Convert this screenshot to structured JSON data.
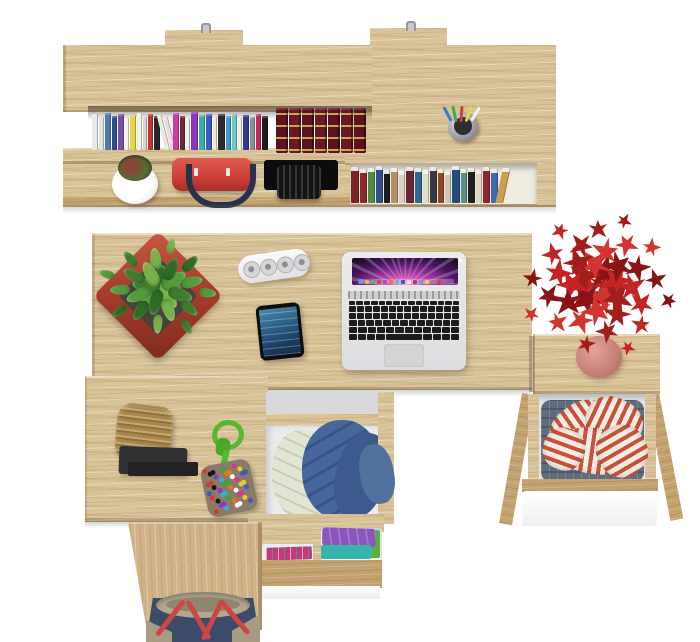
{
  "meta": {
    "description": "Top-down 3D product render of a light-oak desk set: wall shelf with books, main desk with laptop, phone, power strip and plants, open drawers with clothes, pedestal and duffel bag",
    "canvas": {
      "width": 700,
      "height": 642
    },
    "background": "#ffffff"
  },
  "palette": {
    "wood": "#d9c399",
    "wood_vertical": "#cfb287",
    "wood_edge": "#c3a26f",
    "white_front": "#ffffff",
    "shadow": "rgba(90,85,75,0.30)"
  },
  "shelf": {
    "hanger_count": 2,
    "hook_color": "#9a9a9c",
    "row1_spines": [
      {
        "w": 6,
        "c": "#e9e9e9",
        "h": 36
      },
      {
        "w": 5,
        "c": "#dfe3e6",
        "h": 33
      },
      {
        "w": 6,
        "c": "#4e7ab0",
        "h": 37
      },
      {
        "w": 5,
        "c": "#2e4e8e",
        "h": 34
      },
      {
        "w": 6,
        "c": "#7a4fa8",
        "h": 36
      },
      {
        "w": 4,
        "c": "#f2f0ec",
        "h": 32
      },
      {
        "w": 6,
        "c": "#e8d24a",
        "h": 35
      },
      {
        "w": 5,
        "c": "#f5f2e4",
        "h": 37
      },
      {
        "w": 4,
        "c": "#d8d5cf",
        "h": 33
      },
      {
        "w": 5,
        "c": "#c23434",
        "h": 36
      },
      {
        "w": 6,
        "c": "#262628",
        "h": 34
      },
      {
        "w": 5,
        "c": "#ece8e0",
        "h": 35,
        "lean": 14
      },
      {
        "w": 5,
        "c": "#f0d8e0",
        "h": 33,
        "lean": 14
      },
      {
        "w": 6,
        "c": "#d238a2",
        "h": 37
      },
      {
        "w": 5,
        "c": "#6a2a35",
        "h": 34
      },
      {
        "w": 4,
        "c": "#f2eee6",
        "h": 32
      },
      {
        "w": 7,
        "c": "#9232c2",
        "h": 38
      },
      {
        "w": 6,
        "c": "#34b2aa",
        "h": 35
      },
      {
        "w": 6,
        "c": "#3a5ac8",
        "h": 36
      },
      {
        "w": 4,
        "c": "#f0ead8",
        "h": 33
      },
      {
        "w": 7,
        "c": "#2a2a2c",
        "h": 36
      },
      {
        "w": 5,
        "c": "#3a98d2",
        "h": 34
      },
      {
        "w": 5,
        "c": "#6ac8c2",
        "h": 36
      },
      {
        "w": 4,
        "c": "#f2ece2",
        "h": 32
      },
      {
        "w": 6,
        "c": "#30389a",
        "h": 35
      },
      {
        "w": 5,
        "c": "#8a8f96",
        "h": 33
      },
      {
        "w": 5,
        "c": "#c82858",
        "h": 36
      },
      {
        "w": 6,
        "c": "#1e1e20",
        "h": 34
      }
    ],
    "classics": {
      "count": 7,
      "colors": [
        "#5c1220",
        "#6b1826"
      ],
      "gold": "#caa84a",
      "width": 12,
      "height": 45
    },
    "row2_spines": [
      {
        "w": 8,
        "c": "#7a2424",
        "h": 36
      },
      {
        "w": 7,
        "c": "#8a2a2a",
        "h": 34
      },
      {
        "w": 7,
        "c": "#4f8a4a",
        "h": 35
      },
      {
        "w": 7,
        "c": "#2f4f86",
        "h": 37
      },
      {
        "w": 6,
        "c": "#1c1c1e",
        "h": 33
      },
      {
        "w": 7,
        "c": "#b2906a",
        "h": 35
      },
      {
        "w": 6,
        "c": "#d8d2c2",
        "h": 32
      },
      {
        "w": 8,
        "c": "#6b2330",
        "h": 36
      },
      {
        "w": 7,
        "c": "#2a6a8e",
        "h": 35
      },
      {
        "w": 6,
        "c": "#e2dcc8",
        "h": 33
      },
      {
        "w": 7,
        "c": "#3a3a3c",
        "h": 36
      },
      {
        "w": 6,
        "c": "#8a4a2a",
        "h": 34
      },
      {
        "w": 6,
        "c": "#d0c8b4",
        "h": 32
      },
      {
        "w": 8,
        "c": "#254a7e",
        "h": 37
      },
      {
        "w": 6,
        "c": "#5a8e88",
        "h": 34
      },
      {
        "w": 7,
        "c": "#1e2022",
        "h": 35
      },
      {
        "w": 6,
        "c": "#ddd6c4",
        "h": 33
      },
      {
        "w": 7,
        "c": "#8e2430",
        "h": 36
      },
      {
        "w": 7,
        "c": "#3a6ab0",
        "h": 34
      },
      {
        "w": 8,
        "c": "#c8a050",
        "h": 35,
        "lean": -12
      }
    ],
    "pen_cup": {
      "cup_color": "#8e8e90",
      "pens": [
        {
          "c": "#3a7ad0",
          "rot": -28
        },
        {
          "c": "#48a838",
          "rot": -12
        },
        {
          "c": "#d04040",
          "rot": 4
        },
        {
          "c": "#e8d44a",
          "rot": 18
        },
        {
          "c": "#f2f2f2",
          "rot": 32
        }
      ]
    },
    "items": {
      "cup_plant": {
        "pot": "#ffffff",
        "plant": "#5a6a34"
      },
      "red_bag": {
        "body": "#cc3f38",
        "handles": "#27324a"
      },
      "camera_bag": {
        "body": "#141416"
      }
    }
  },
  "laptop": {
    "body_color": "#e6e6e8",
    "key_color": "#1c1c1e",
    "screen_colors": [
      "#f0a0e0",
      "#d455b8",
      "#8a2f97",
      "#4a1560",
      "#1e0c28"
    ],
    "keyboard_rows": [
      {
        "keys": 15,
        "h": 4
      },
      {
        "keys": 14,
        "h": 6
      },
      {
        "keys": 14,
        "h": 6
      },
      {
        "keys": 13,
        "h": 6
      },
      {
        "keys": 12,
        "h": 6
      },
      {
        "keys": 9,
        "h": 6,
        "space": true
      }
    ],
    "dock_colors": [
      "#4aa8e8",
      "#e8b84a",
      "#58b848",
      "#d04848",
      "#9a58c8",
      "#e87838",
      "#48c8c0",
      "#3858c8",
      "#e8e8e8",
      "#b03878",
      "#58a8d8",
      "#e8d44a",
      "#888890",
      "#c04838"
    ]
  },
  "phone": {
    "body": "#0e0e10",
    "screen_top": "#4a89a8",
    "screen_bottom": "#122c48"
  },
  "power_strip": {
    "body": "#f2f2f4",
    "socket_count": 4,
    "socket_color": "#8e8e92"
  },
  "green_plant": {
    "name": "succulent-leaf",
    "count": 26,
    "cx": 160,
    "cy": 288,
    "a0": 0,
    "r0": 6,
    "rstep": 2.0,
    "squash": 0.82,
    "s0": 30,
    "sdec": 0.6,
    "smin": 12,
    "colors": [
      "#3f7d2e",
      "#559b3b",
      "#2e6b24",
      "#77b24a"
    ],
    "pot_color": "#a83d2c"
  },
  "red_plant": {
    "name": "maple-leaf",
    "count": 38,
    "cx": 598,
    "cy": 284,
    "a0": 20,
    "r0": 10,
    "rstep": 1.85,
    "squash": 0.88,
    "s0": 34,
    "sdec": 0.55,
    "smin": 13,
    "colors": [
      "#a31d1d",
      "#c32525",
      "#881414",
      "#d23530"
    ],
    "star": true,
    "pot_color": "#c47f76"
  },
  "basket": {
    "weave": "#b08f56",
    "tray": "#313134"
  },
  "rope_toy": {
    "rope": "#56b832",
    "pom": {
      "count": 42,
      "w": 50,
      "h": 52,
      "size": 5,
      "colors": [
        "#d23a3a",
        "#3a58c8",
        "#e8c832",
        "#d23a92",
        "#ffffff",
        "#e87820",
        "#38a838",
        "#28b8c8",
        "#8a38c8",
        "#181818"
      ]
    }
  },
  "drawers": {
    "middle": {
      "interior": "#ececee",
      "cream_clothes": "#e2e5d4",
      "hoodie": "#47679c"
    },
    "bottom": {
      "purple": "#8a55bd",
      "teal": "#35b5ad",
      "green": "#5ab23e",
      "pink_case": "#c23a78"
    },
    "right": {
      "interior": "#e4e4e6",
      "denim": "#5e6c7e",
      "front": "#ffffff",
      "stripe_bg": "#f3ede5",
      "stripe_color": "#c7533a",
      "stripe_patches": [
        {
          "x": 548,
          "y": 404,
          "w": 62,
          "h": 44,
          "rot": -35
        },
        {
          "x": 585,
          "y": 398,
          "w": 58,
          "h": 48,
          "rot": 25
        },
        {
          "x": 558,
          "y": 428,
          "w": 72,
          "h": 46,
          "rot": 8
        },
        {
          "x": 596,
          "y": 426,
          "w": 52,
          "h": 50,
          "rot": 60
        },
        {
          "x": 543,
          "y": 428,
          "w": 42,
          "h": 42,
          "rot": -70
        }
      ]
    }
  },
  "duffel": {
    "body": "#3c4c68",
    "rim": "#b3a88e",
    "straps": "#cf4444",
    "corners": "#a79b82"
  }
}
